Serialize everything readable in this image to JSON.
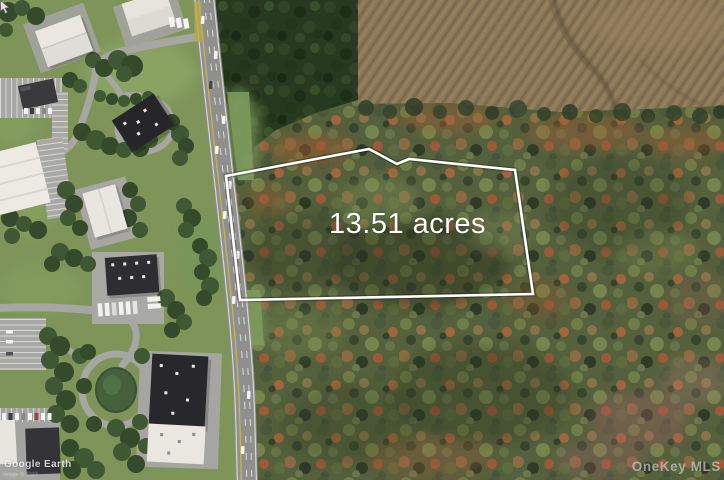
{
  "photo": {
    "parcel": {
      "label": "13.51 acres",
      "acres": 13.51,
      "boundary_color": "#ffffff"
    },
    "watermarks": {
      "provider": "OneKey MLS",
      "imagery": "Google Earth",
      "attribution_small": "Image © 2023"
    },
    "palette": {
      "autumn_canopy": "#55603c",
      "conifer_canopy": "#27391f",
      "field_brown": "#8d785a",
      "road_gray": "#a6a6a2",
      "highway_gray": "#8f8f8d",
      "grass_green": "#7e9459",
      "label_text": "#fbfbfb"
    }
  }
}
